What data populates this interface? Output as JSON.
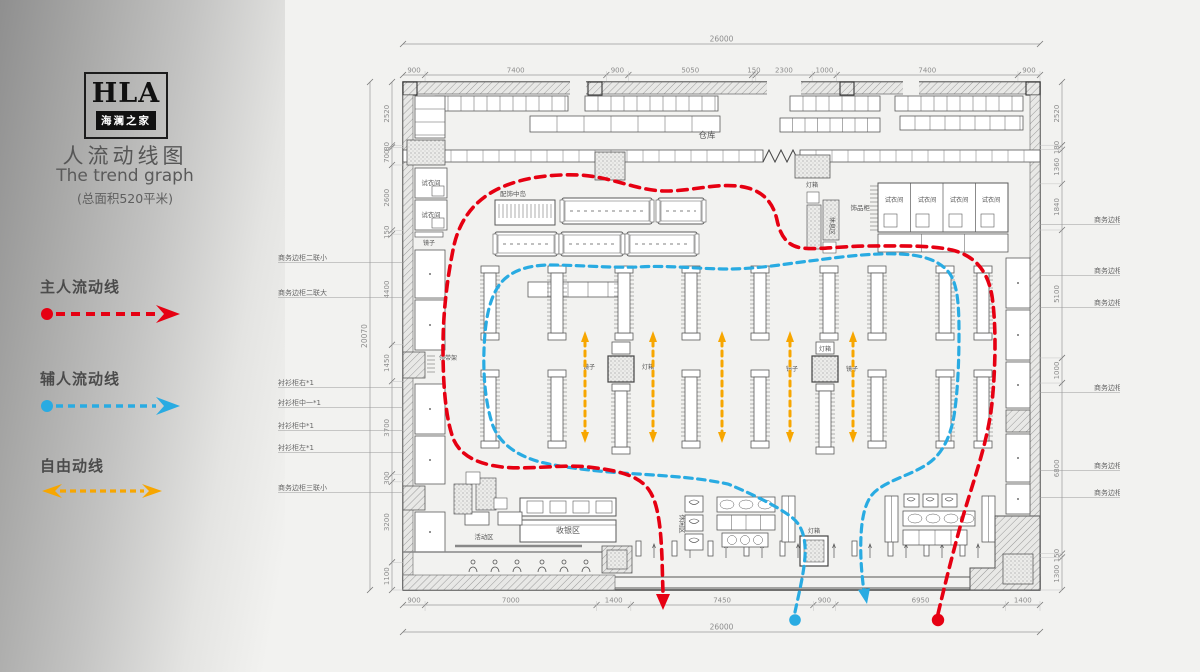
{
  "sidebar": {
    "logo_main": "HLA",
    "logo_sub": "海澜之家",
    "title_cn": "人流动线图",
    "title_en": "The trend graph",
    "area_note": "(总面积520平米)",
    "legend": {
      "main": {
        "label": "主人流动线",
        "color": "#e60012"
      },
      "aux": {
        "label": "辅人流动线",
        "color": "#29abe2"
      },
      "free": {
        "label": "自由动线",
        "color": "#f7a600"
      }
    }
  },
  "plan": {
    "dims": {
      "top_total": "26000",
      "top_segments": [
        "900",
        "7400",
        "900",
        "5050",
        "150",
        "2300",
        "1000",
        "7400",
        "900"
      ],
      "bottom_segments": [
        "900",
        "7000",
        "1400",
        "7450",
        "900",
        "6950",
        "1400"
      ],
      "bottom_total": "26000",
      "left_total": "20070",
      "left_segments": [
        "2520",
        "80",
        "700",
        "2600",
        "150",
        "4400",
        "1450",
        "3700",
        "300",
        "3200",
        "1100"
      ],
      "right_segments": [
        "2520",
        "180",
        "1360",
        "1840",
        "5100",
        "1000",
        "6800",
        "150",
        "1300"
      ]
    },
    "room_labels": {
      "warehouse": "仓库",
      "fitting_room": "试衣间",
      "mirror": "镜子",
      "lightbox": "灯箱",
      "accessory_island": "配饰中岛",
      "accessory_cabinet": "饰品柜",
      "rest_area": "休息区",
      "tie_rack": "领带架",
      "cashier": "收银区",
      "activity_area": "活动区",
      "lounge": "休闲区"
    },
    "left_wall_labels": [
      "商务边柜二联小",
      "商务边柜二联大",
      "衬衫柜右*1",
      "衬衫柜中一*1",
      "衬衫柜中*1",
      "衬衫柜左*1",
      "商务边柜三联小"
    ],
    "right_wall_labels": [
      "商务边柜三联小",
      "商务边柜二联大",
      "商务边柜二联大",
      "商务边柜二联小",
      "商务边柜三联小",
      "商务边柜二联小"
    ]
  }
}
